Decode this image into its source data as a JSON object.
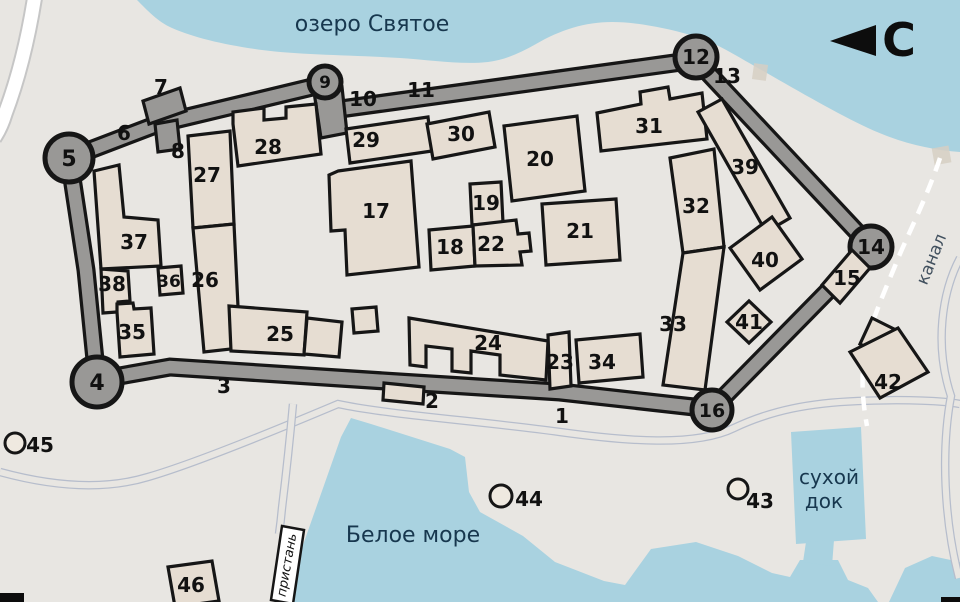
{
  "map": {
    "numbers": {
      "n1": "1",
      "n2": "2",
      "n3": "3",
      "n4": "4",
      "n5": "5",
      "n6": "6",
      "n7": "7",
      "n8": "8",
      "n9": "9",
      "n10": "10",
      "n11": "11",
      "n12": "12",
      "n13": "13",
      "n14": "14",
      "n15": "15",
      "n16": "16",
      "n17": "17",
      "n18": "18",
      "n19": "19",
      "n20": "20",
      "n21": "21",
      "n22": "22",
      "n23": "23",
      "n24": "24",
      "n25": "25",
      "n26": "26",
      "n27": "27",
      "n28": "28",
      "n29": "29",
      "n30": "30",
      "n31": "31",
      "n32": "32",
      "n33": "33",
      "n34": "34",
      "n35": "35",
      "n36": "36",
      "n37": "37",
      "n38": "38",
      "n39": "39",
      "n40": "40",
      "n41": "41",
      "n42": "42",
      "n43": "43",
      "n44": "44",
      "n45": "45",
      "n46": "46"
    },
    "water_labels": {
      "lake": "озеро Святое",
      "sea": "Белое море",
      "dry_dock_line1": "сухой",
      "dry_dock_line2": "док",
      "canal": "канал",
      "pier": "пристань"
    },
    "compass": {
      "north_letter": "С",
      "direction": "north-left"
    },
    "colors": {
      "land": "#e8e6e2",
      "water": "#a9d2e0",
      "wall": "#999896",
      "building": "#e6ddd2",
      "outline": "#161616",
      "water_text": "#17374e",
      "road_edge": "#b6bdcc"
    }
  }
}
